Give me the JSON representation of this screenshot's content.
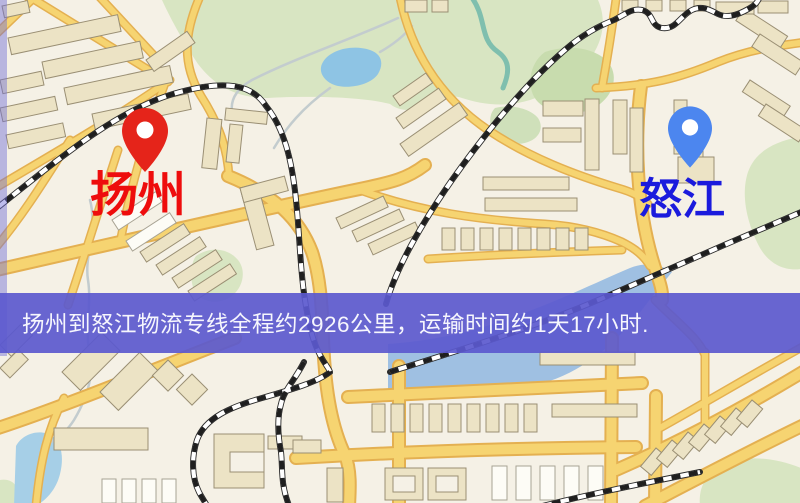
{
  "map": {
    "origin": {
      "label": "扬州",
      "pin_color": "#e5241a",
      "label_color": "#ee0d0d"
    },
    "destination": {
      "label": "怒江",
      "pin_color": "#4c86ef",
      "label_color": "#1b1bdd"
    },
    "banner": {
      "text": "扬州到怒江物流专线全程约2926公里，运输时间约1天17小时.",
      "background_color": "#5b59ce",
      "text_color": "#ffffff"
    },
    "theme": {
      "land_color": "#f5f1e6",
      "road_color": "#f4cf6b",
      "water_color": "#a6cfe7",
      "park_color": "#d8e5c2",
      "railway_color": "#2b2b2b",
      "building_color": "#ece3c5"
    }
  }
}
